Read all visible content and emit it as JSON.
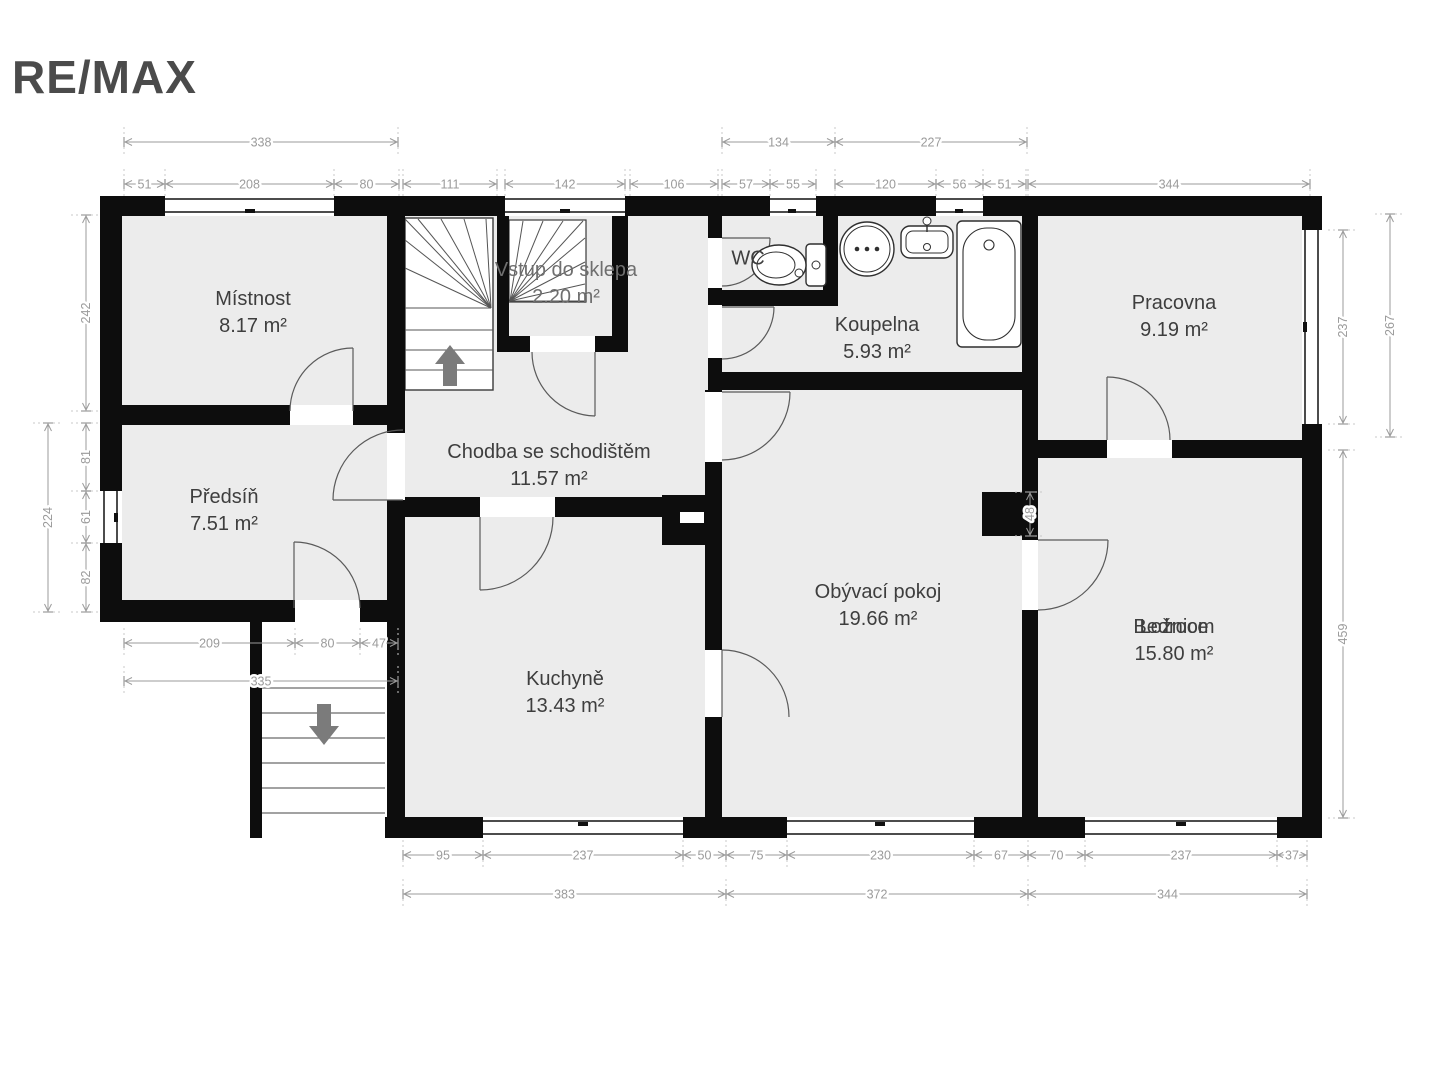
{
  "brand": {
    "name": "RE/MAX"
  },
  "plan": {
    "rooms": [
      {
        "id": "mistnost",
        "name": "Místnost",
        "area": "8.17 m²"
      },
      {
        "id": "predsin",
        "name": "Předsíň",
        "area": "7.51 m²"
      },
      {
        "id": "vstup",
        "name": "Vstup do sklepa",
        "area": "2.20 m²"
      },
      {
        "id": "chodba",
        "name": "Chodba se schodištěm",
        "area": "11.57 m²"
      },
      {
        "id": "wc",
        "name": "WC",
        "area": ""
      },
      {
        "id": "koupelna",
        "name": "Koupelna",
        "area": "5.93 m²"
      },
      {
        "id": "pracovna",
        "name": "Pracovna",
        "area": "9.19 m²"
      },
      {
        "id": "obyvaci",
        "name": "Obývací pokoj",
        "area": "19.66 m²"
      },
      {
        "id": "kuchyne",
        "name": "Kuchyně",
        "area": "13.43 m²"
      },
      {
        "id": "loznice",
        "name": "Ložnice",
        "name_overlap": "Bedroom",
        "area": "15.80 m²"
      }
    ],
    "colors": {
      "wall": "#0d0d0d",
      "floor": "#ececec",
      "dim": "#9b9b9b",
      "label": "#3e3e3e",
      "arrow": "#7b7b7b"
    },
    "icons": [
      "up-arrow-icon",
      "down-arrow-icon",
      "toilet-icon",
      "washing-machine-icon",
      "sink-icon",
      "bathtub-icon"
    ],
    "dimensions": [
      {
        "label": "338",
        "o": "h",
        "x": 124,
        "y": 142,
        "len": 274
      },
      {
        "label": "134",
        "o": "h",
        "x": 722,
        "y": 142,
        "len": 113
      },
      {
        "label": "227",
        "o": "h",
        "x": 835,
        "y": 142,
        "len": 192
      },
      {
        "label": "51",
        "o": "h",
        "x": 124,
        "y": 184,
        "len": 41
      },
      {
        "label": "208",
        "o": "h",
        "x": 165,
        "y": 184,
        "len": 169
      },
      {
        "label": "80",
        "o": "h",
        "x": 334,
        "y": 184,
        "len": 65
      },
      {
        "label": "111",
        "o": "h",
        "x": 403,
        "y": 184,
        "len": 94
      },
      {
        "label": "142",
        "o": "h",
        "x": 505,
        "y": 184,
        "len": 120
      },
      {
        "label": "106",
        "o": "h",
        "x": 630,
        "y": 184,
        "len": 88
      },
      {
        "label": "57",
        "o": "h",
        "x": 722,
        "y": 184,
        "len": 48
      },
      {
        "label": "55",
        "o": "h",
        "x": 770,
        "y": 184,
        "len": 46
      },
      {
        "label": "120",
        "o": "h",
        "x": 835,
        "y": 184,
        "len": 101
      },
      {
        "label": "56",
        "o": "h",
        "x": 936,
        "y": 184,
        "len": 47
      },
      {
        "label": "51",
        "o": "h",
        "x": 983,
        "y": 184,
        "len": 43
      },
      {
        "label": "344",
        "o": "h",
        "x": 1028,
        "y": 184,
        "len": 282
      },
      {
        "label": "209",
        "o": "h",
        "x": 124,
        "y": 643,
        "len": 171
      },
      {
        "label": "80",
        "o": "h",
        "x": 295,
        "y": 643,
        "len": 65
      },
      {
        "label": "47",
        "o": "h",
        "x": 360,
        "y": 643,
        "len": 38
      },
      {
        "label": "335",
        "o": "h",
        "x": 124,
        "y": 681,
        "len": 274
      },
      {
        "label": "95",
        "o": "h",
        "x": 403,
        "y": 855,
        "len": 80
      },
      {
        "label": "237",
        "o": "h",
        "x": 483,
        "y": 855,
        "len": 200
      },
      {
        "label": "50",
        "o": "h",
        "x": 683,
        "y": 855,
        "len": 43
      },
      {
        "label": "75",
        "o": "h",
        "x": 726,
        "y": 855,
        "len": 61
      },
      {
        "label": "230",
        "o": "h",
        "x": 787,
        "y": 855,
        "len": 187
      },
      {
        "label": "67",
        "o": "h",
        "x": 974,
        "y": 855,
        "len": 54
      },
      {
        "label": "70",
        "o": "h",
        "x": 1028,
        "y": 855,
        "len": 57
      },
      {
        "label": "237",
        "o": "h",
        "x": 1085,
        "y": 855,
        "len": 192
      },
      {
        "label": "37",
        "o": "h",
        "x": 1277,
        "y": 855,
        "len": 30
      },
      {
        "label": "383",
        "o": "h",
        "x": 403,
        "y": 894,
        "len": 323
      },
      {
        "label": "372",
        "o": "h",
        "x": 726,
        "y": 894,
        "len": 302
      },
      {
        "label": "344",
        "o": "h",
        "x": 1028,
        "y": 894,
        "len": 279
      },
      {
        "label": "242",
        "o": "v",
        "x": 86,
        "y": 215,
        "len": 196
      },
      {
        "label": "224",
        "o": "v",
        "x": 48,
        "y": 423,
        "len": 189
      },
      {
        "label": "81",
        "o": "v",
        "x": 86,
        "y": 423,
        "len": 68
      },
      {
        "label": "61",
        "o": "v",
        "x": 86,
        "y": 491,
        "len": 52
      },
      {
        "label": "82",
        "o": "v",
        "x": 86,
        "y": 543,
        "len": 69
      },
      {
        "label": "237",
        "o": "v",
        "x": 1343,
        "y": 230,
        "len": 194
      },
      {
        "label": "267",
        "o": "v",
        "x": 1390,
        "y": 214,
        "len": 223
      },
      {
        "label": "48",
        "o": "v",
        "x": 1030,
        "y": 492,
        "len": 44
      },
      {
        "label": "459",
        "o": "v",
        "x": 1343,
        "y": 450,
        "len": 368
      }
    ]
  }
}
